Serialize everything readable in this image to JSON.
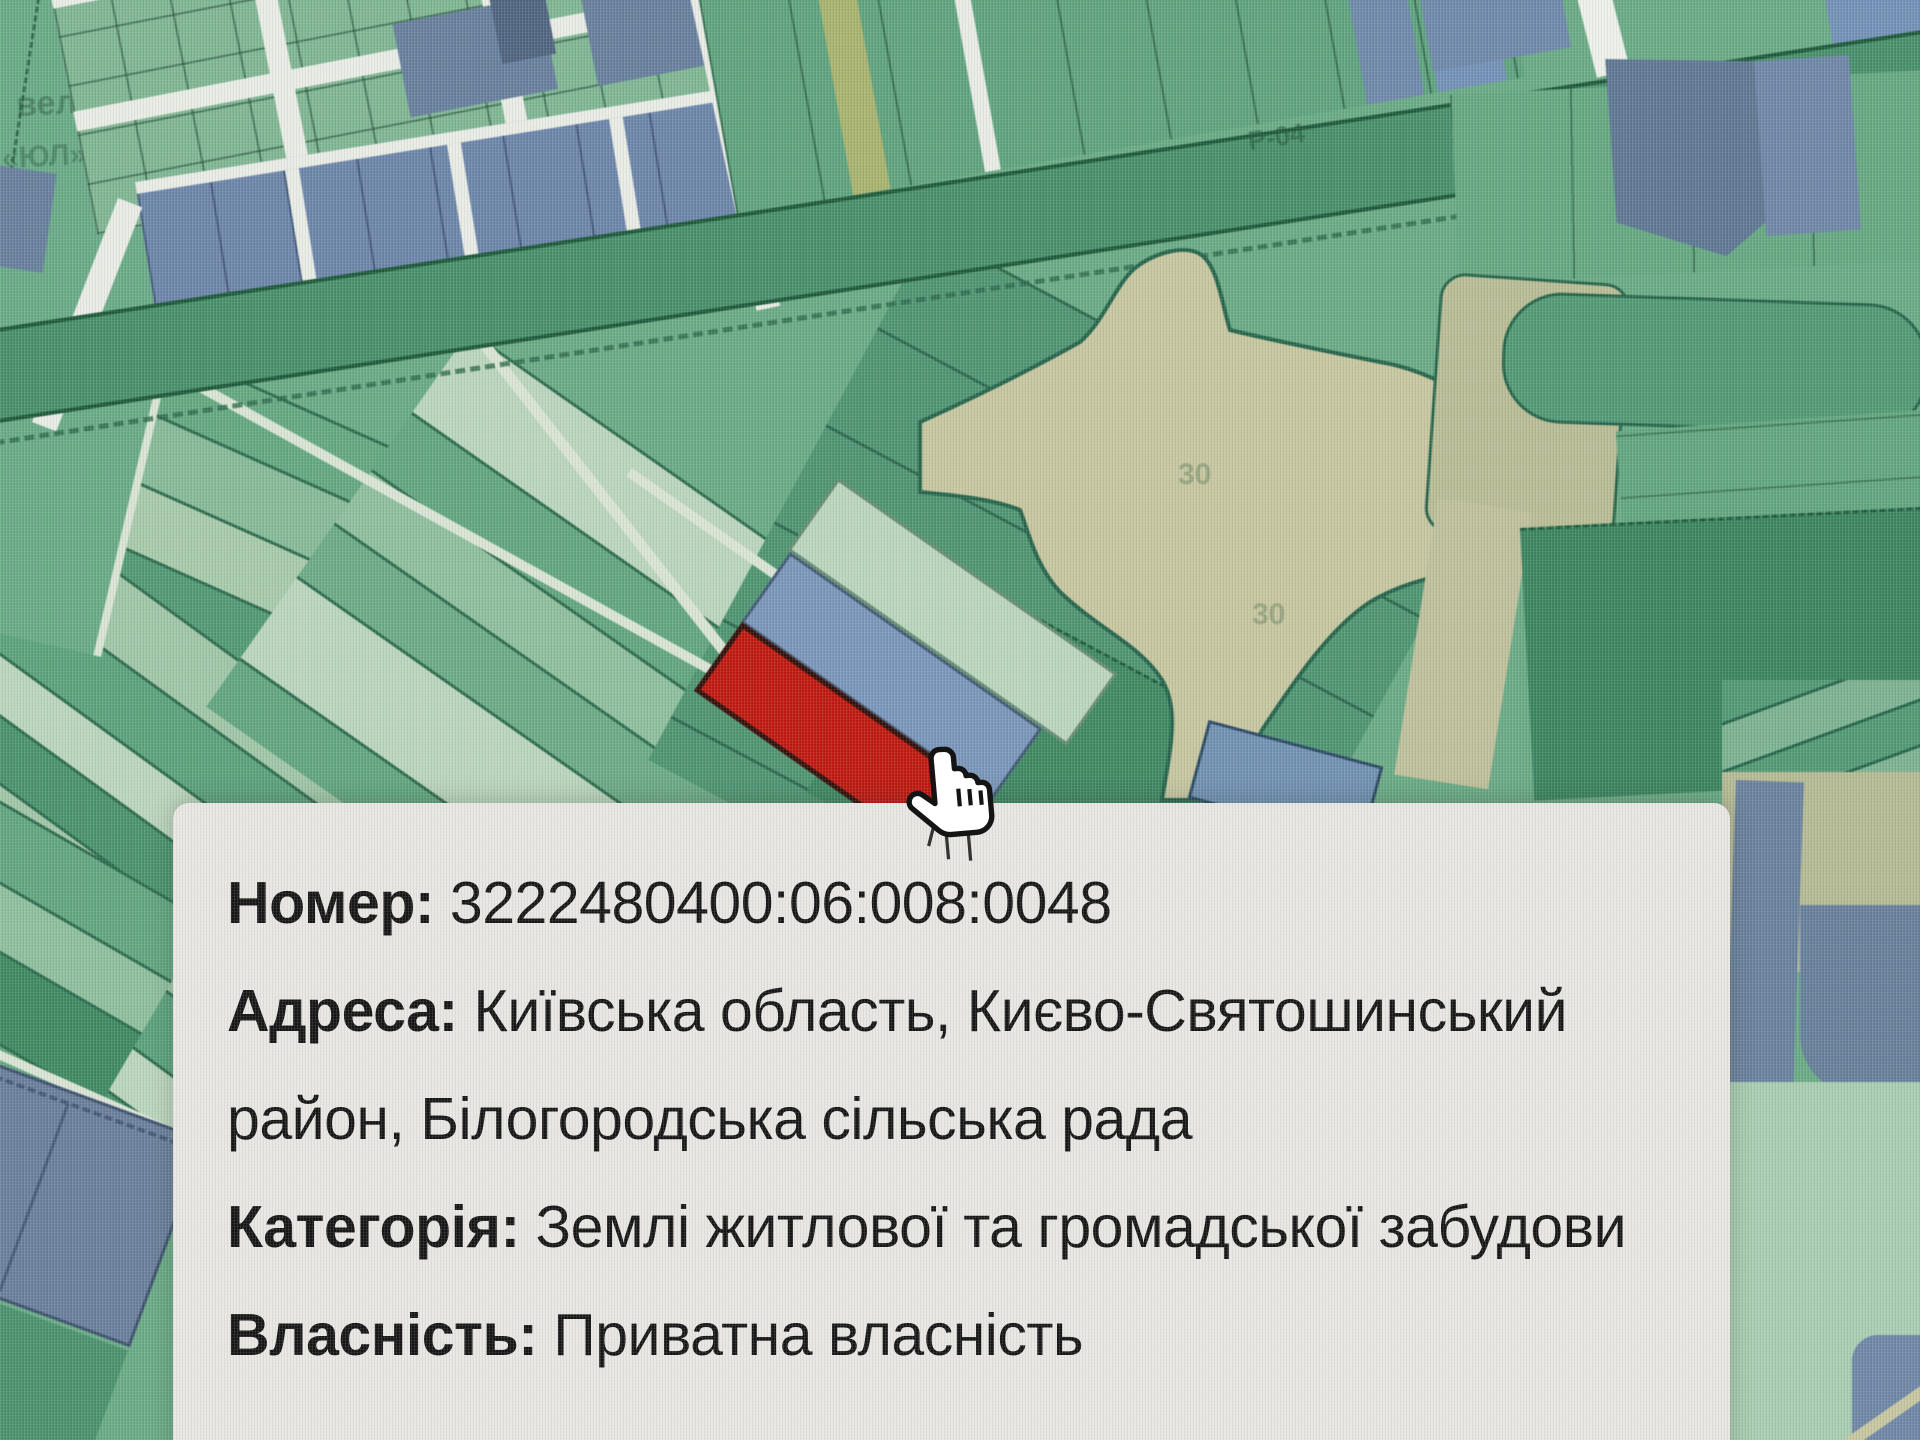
{
  "popup": {
    "fields": [
      {
        "label": "Номер:",
        "value": "3222480400:06:008:0048"
      },
      {
        "label": "Адреса:",
        "value": "Київська область, Києво-Святошинський район, Білогородська сільська рада"
      },
      {
        "label": "Категорія:",
        "value": "Землі житлової та громадської забудови"
      },
      {
        "label": "Власність:",
        "value": "Приватна власність"
      }
    ],
    "background": "#e7e6e2",
    "text_color": "#161616"
  },
  "map": {
    "labels": {
      "road": "Р-04",
      "faint_topleft_line1": "вело",
      "faint_topleft_line2": "«ЮЛ»",
      "parcel_hint_1": "30",
      "parcel_hint_2": "30"
    },
    "colors": {
      "selected_parcel_red": "#c6170e",
      "parcel_blue": "#7996bc",
      "parcel_blue_dark": "#5e7895",
      "parcel_green": "#61a980",
      "parcel_green_dark": "#3c8a62",
      "parcel_green_pale": "#a6cbaa",
      "road_band_green": "#45906a",
      "street_white": "#eef0ea",
      "corridor_tan": "#c6c69e"
    }
  },
  "cursor": {
    "type": "hand-pointer"
  }
}
